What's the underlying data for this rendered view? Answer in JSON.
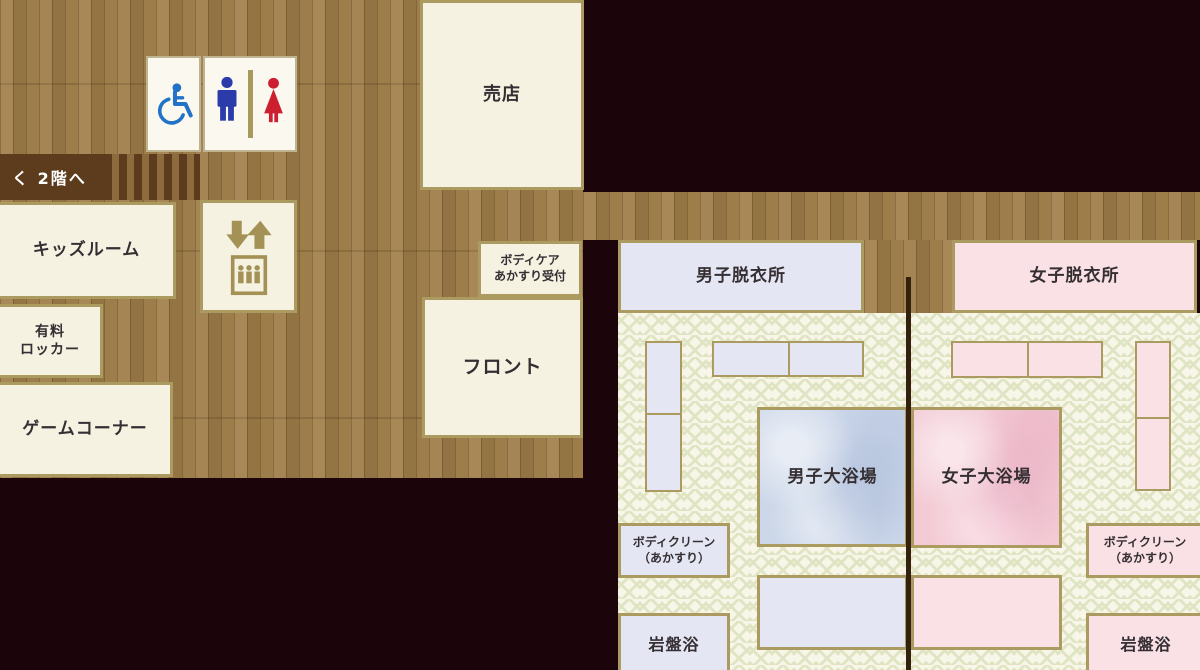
{
  "title": "大浴場フロア案内図（1階 floor map）",
  "colors": {
    "dark_bg": "#1c040b",
    "wood_base": "#9d7d4a",
    "stair_brown": "#5d3b1d",
    "stair_light": "#8d6b3c",
    "cream": "#f6f2e2",
    "border_tan": "#ab9b60",
    "toilet_border": "#bfb491",
    "lavender": "#e4e6f3",
    "pink": "#f9e1e5",
    "bath_blue": "#ccd7e9",
    "bath_pink": "#f3cbd5",
    "pattern_bg": "#f7f6e8",
    "pattern_olive": "#dfe4c2",
    "divider_brown": "#33200d",
    "wheelchair_blue": "#2272c8",
    "man_blue": "#2b3caa",
    "woman_red": "#cc2030",
    "elevator_khaki": "#a39155",
    "label_text": "#352f33"
  },
  "stairs": {
    "label": "く 2階へ"
  },
  "shop": {
    "label": "売店"
  },
  "kids_room": {
    "label": "キッズルーム"
  },
  "paid_locker": {
    "line1": "有料",
    "line2": "ロッカー"
  },
  "game_corner": {
    "label": "ゲームコーナー"
  },
  "front_desk": {
    "label": "フロント"
  },
  "bodycare_reception": {
    "line1": "ボディケア",
    "line2": "あかすり受付"
  },
  "mens": {
    "dressing_room": "男子脱衣所",
    "bath": "男子大浴場",
    "bodyclean_line1": "ボディクリーン",
    "bodyclean_line2": "（あかすり）",
    "stone_sauna": "岩盤浴"
  },
  "womens": {
    "dressing_room": "女子脱衣所",
    "bath": "女子大浴場",
    "bodyclean_line1": "ボディクリーン",
    "bodyclean_line2": "（あかすり）",
    "stone_sauna": "岩盤浴"
  },
  "icons": {
    "wheelchair": "wheelchair-accessible symbol (blue)",
    "mens_toilet": "man pictogram (blue)",
    "womens_toilet": "woman pictogram (red)",
    "toilet_divider": "khaki separator bar",
    "elevator": "up/down arrows above elevator car with passengers (khaki)"
  }
}
